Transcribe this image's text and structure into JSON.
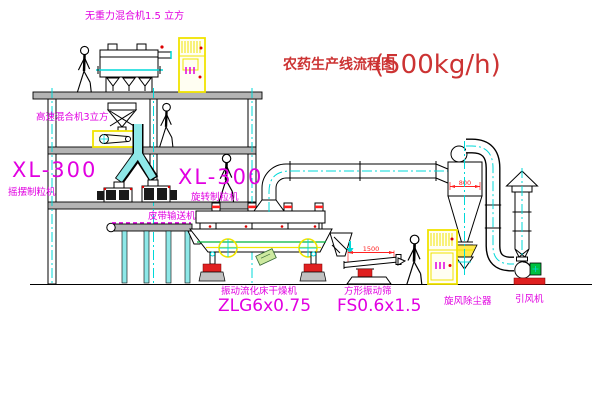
{
  "diagram": {
    "title": {
      "zh": "农药生产线流程图",
      "capacity": "(500kg/h)"
    },
    "equipment_labels": {
      "gravity_mixer": "无重力混合机1.5 立方",
      "high_speed_mixer": "高速混合机3立方",
      "granulator_left_model": "XL-300",
      "granulator_left_name": "摇摆制粒机",
      "granulator_mid_model": "XL-300",
      "granulator_mid_name": "旋转制粒机",
      "belt_conveyor": "皮带输送机",
      "dryer_name": "振动流化床干燥机",
      "dryer_model": "ZLG6x0.75",
      "sieve_name": "方形振动筛",
      "sieve_model": "FS0.6x1.5",
      "cyclone": "旋风除尘器",
      "fan": "引风机"
    },
    "dimensions": {
      "sieve_length": "1500",
      "cyclone_body": "800"
    },
    "colors": {
      "label": "#e100e1",
      "title": "#cc3333",
      "centerline": "#00d8d8",
      "cabinet": "#f0e400",
      "accent": "#e02020",
      "motor": "#00c040",
      "dim": "#ff2020"
    }
  }
}
